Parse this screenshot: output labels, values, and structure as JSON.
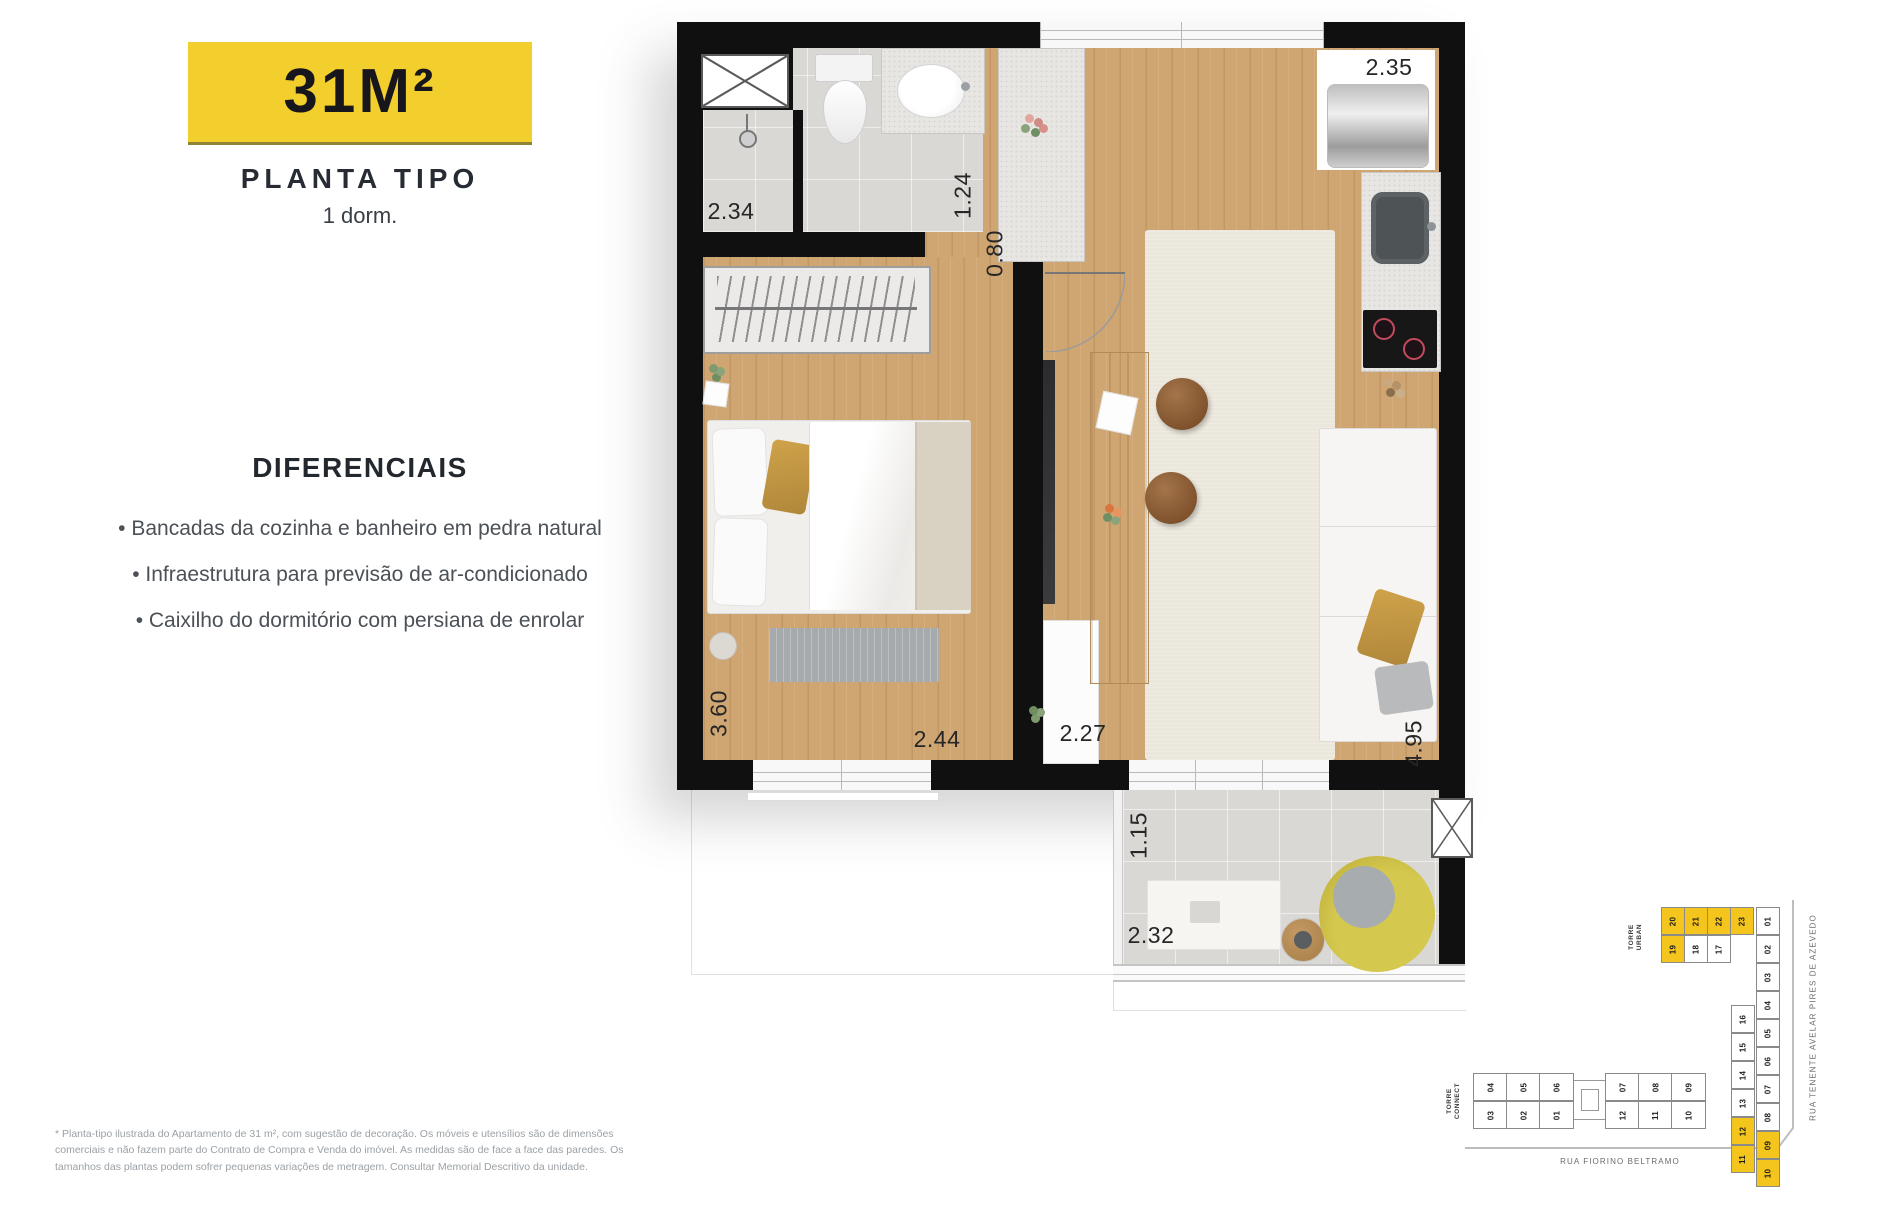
{
  "panel": {
    "area_badge": "31M²",
    "plan_type": "PLANTA TIPO",
    "dorms": "1 dorm.",
    "diff_title": "DIFERENCIAIS",
    "diff_items": [
      "• Bancadas da cozinha e banheiro em pedra natural",
      "• Infraestrutura para previsão de ar-condicionado",
      "• Caixilho do dormitório com persiana de enrolar"
    ],
    "disclaimer": "* Planta-tipo ilustrada do Apartamento de 31 m², com sugestão de decoração. Os móveis e utensílios são de dimensões comerciais e não fazem parte do Contrato de Compra e Venda do imóvel. As medidas são de face a face das paredes. Os tamanhos das plantas podem sofrer pequenas variações de metragem. Consultar Memorial Descritivo da unidade."
  },
  "colors": {
    "badge_yellow": "#f2cf2d",
    "unit_highlight_yellow": "#f4c51c",
    "wall_black": "#101010",
    "wood_floor": "#cfa571",
    "tile_gray": "#dad8d5"
  },
  "floorplan": {
    "labels": {
      "shower": "2.34",
      "bathroom": "1.24",
      "hall": "0.80",
      "laundry": "2.35",
      "bedroom_depth": "3.60",
      "bedroom_width": "2.44",
      "living_width": "2.27",
      "living_depth": "4.95",
      "balcony_depth": "1.15",
      "balcony_width": "2.32"
    }
  },
  "siteplan": {
    "torre_urban": {
      "label_lines": [
        "TORRE",
        "URBAN"
      ],
      "row1": [
        {
          "n": "20",
          "hl": true
        },
        {
          "n": "21",
          "hl": true
        },
        {
          "n": "22",
          "hl": true
        },
        {
          "n": "23",
          "hl": true
        }
      ],
      "row2": [
        {
          "n": "19",
          "hl": true
        },
        {
          "n": "18",
          "hl": false
        },
        {
          "n": "17",
          "hl": false
        }
      ],
      "col_right": [
        {
          "n": "01",
          "hl": false
        },
        {
          "n": "02",
          "hl": false
        },
        {
          "n": "03",
          "hl": false
        },
        {
          "n": "04",
          "hl": false
        },
        {
          "n": "05",
          "hl": false
        },
        {
          "n": "06",
          "hl": false
        },
        {
          "n": "07",
          "hl": false
        },
        {
          "n": "08",
          "hl": false
        },
        {
          "n": "09",
          "hl": true
        },
        {
          "n": "10",
          "hl": true
        }
      ],
      "col_inner": [
        {
          "n": "16",
          "hl": false
        },
        {
          "n": "15",
          "hl": false
        },
        {
          "n": "14",
          "hl": false
        },
        {
          "n": "13",
          "hl": false
        },
        {
          "n": "12",
          "hl": true
        },
        {
          "n": "11",
          "hl": true
        }
      ]
    },
    "torre_connect": {
      "label_lines": [
        "TORRE",
        "CONNECT"
      ],
      "row_top": [
        "04",
        "05",
        "06",
        "07",
        "08",
        "09"
      ],
      "row_bottom": [
        "03",
        "02",
        "01",
        "12",
        "11",
        "10"
      ]
    },
    "streets": {
      "bottom": "RUA FIORINO BELTRAMO",
      "side": "RUA TENENTE AVELAR PIRES DE AZEVEDO"
    }
  }
}
